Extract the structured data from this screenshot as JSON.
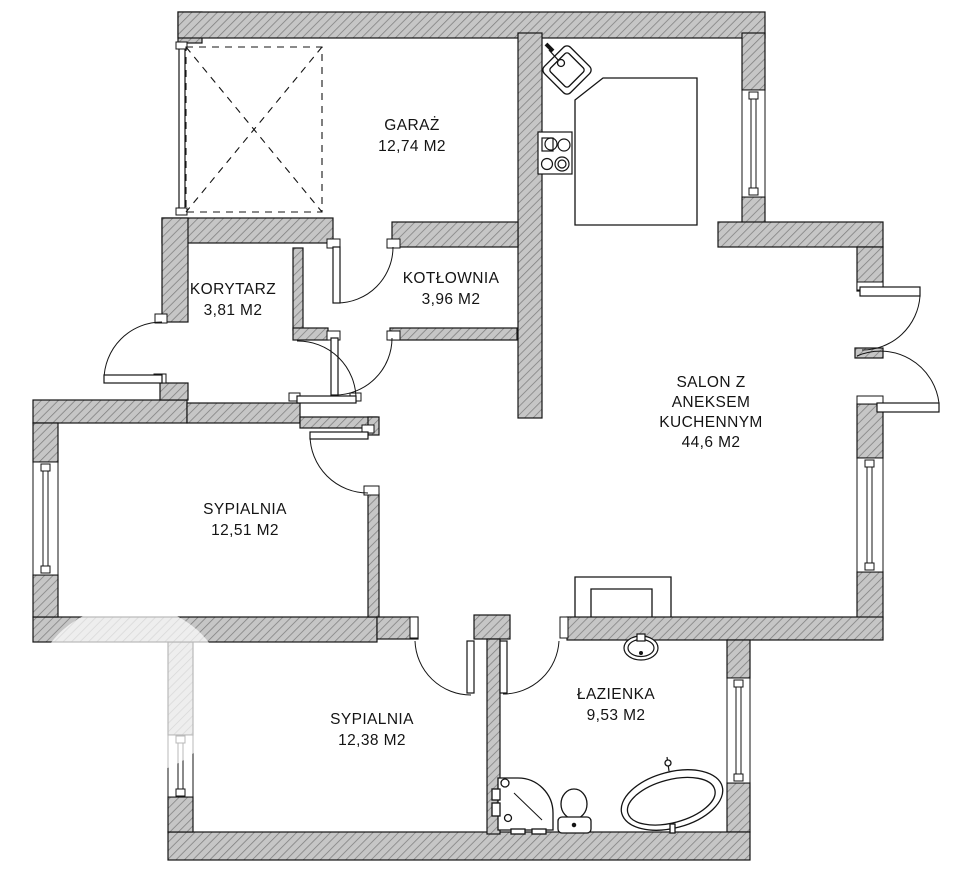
{
  "plan": {
    "rooms": [
      {
        "key": "garaz",
        "name": "GARAŻ",
        "area": "12,74 M2"
      },
      {
        "key": "kotlownia",
        "name": "KOTŁOWNIA",
        "area": "3,96 M2"
      },
      {
        "key": "korytarz",
        "name": "KORYTARZ",
        "area": "3,81 M2"
      },
      {
        "key": "salon",
        "name_lines": [
          "SALON Z",
          "ANEKSEM",
          "KUCHENNYM"
        ],
        "area": "44,6 M2"
      },
      {
        "key": "sypialnia-1",
        "name": "SYPIALNIA",
        "area": "12,51 M2"
      },
      {
        "key": "sypialnia-2",
        "name": "SYPIALNIA",
        "area": "12,38 M2"
      },
      {
        "key": "lazienka",
        "name": "ŁAZIENKA",
        "area": "9,53 M2"
      }
    ],
    "fixtures": [
      "kitchen-sink",
      "cooktop",
      "kitchen-counter",
      "fireplace",
      "washbasin",
      "toilet",
      "shower",
      "bathtub",
      "garage-gate"
    ],
    "colors": {
      "wall_fill": "#c6c6c6",
      "wall_hatch": "#7d7d7d",
      "outline": "#141414",
      "background": "#ffffff"
    }
  }
}
